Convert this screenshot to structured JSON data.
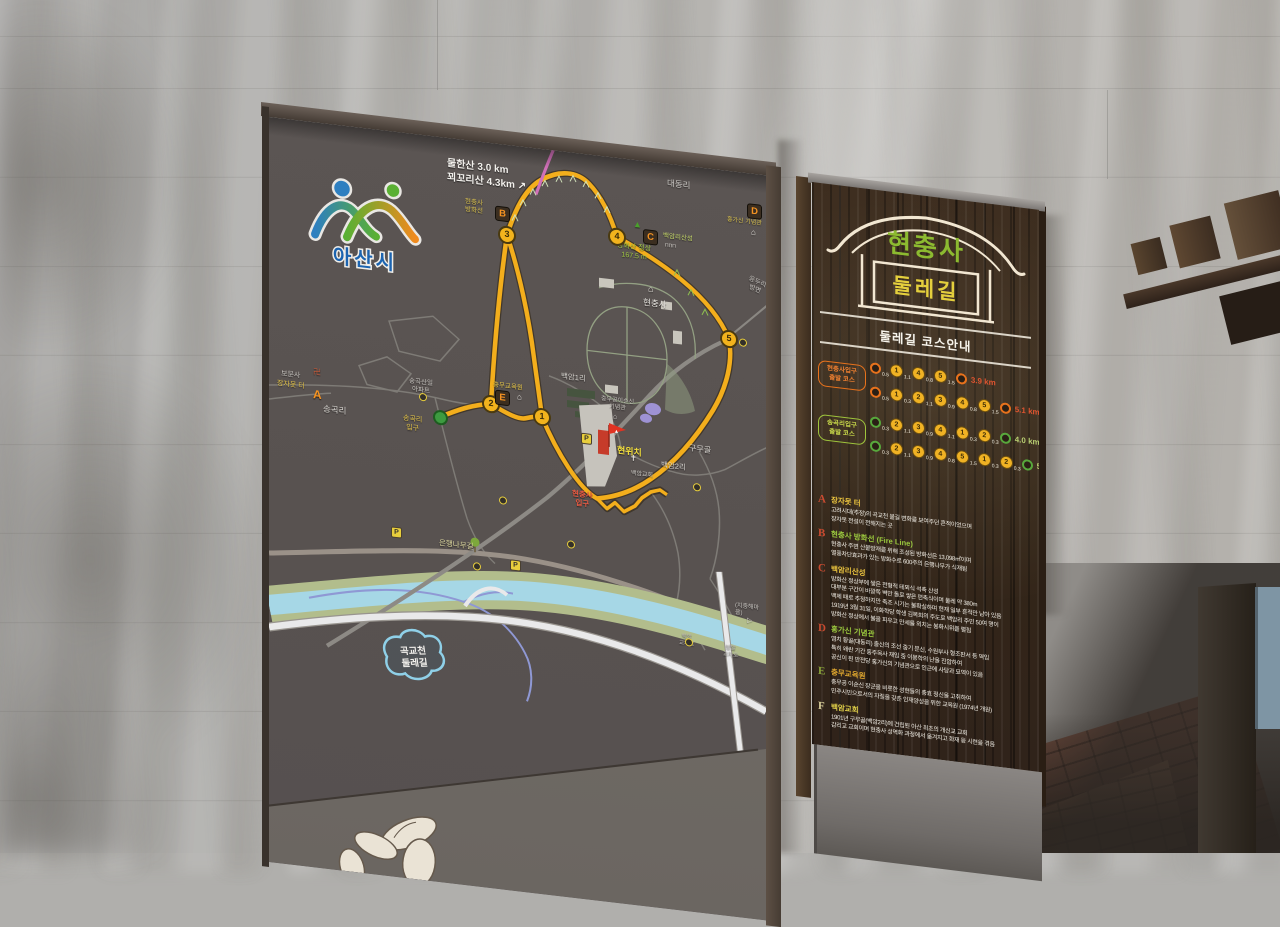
{
  "asan_city": {
    "name": "아산시"
  },
  "map": {
    "labels": [
      {
        "t": "물한산   3.0 km",
        "x": 178,
        "y": 20,
        "fs": 10,
        "c": "#f2f0ec",
        "w": 1
      },
      {
        "t": "꾀꼬리산  4.3km ↗",
        "x": 178,
        "y": 34,
        "fs": 10,
        "c": "#f2f0ec",
        "w": 1
      },
      {
        "t": "대동리",
        "x": 398,
        "y": 14,
        "fs": 8.5,
        "c": "#cfccc8"
      },
      {
        "t": "현충사\n방화선",
        "x": 196,
        "y": 58,
        "fs": 6.5,
        "c": "#d8c050",
        "ta": "center"
      },
      {
        "t": "백암리산성",
        "x": 394,
        "y": 69,
        "fs": 6.5,
        "c": "#c6d86a"
      },
      {
        "t": "방화산 정상\n167.5 m",
        "x": 348,
        "y": 84,
        "fs": 7,
        "c": "#a2c845",
        "ta": "center"
      },
      {
        "t": "홍가신 기념관",
        "x": 458,
        "y": 46,
        "fs": 6,
        "c": "#d8c050"
      },
      {
        "t": "응두리\n방면",
        "x": 478,
        "y": 104,
        "fs": 6.5,
        "c": "#c8c5c0",
        "r": 18,
        "ta": "center"
      },
      {
        "t": "현충사",
        "x": 374,
        "y": 136,
        "fs": 8.5,
        "c": "#e8e5e0"
      },
      {
        "t": "보문사",
        "x": 12,
        "y": 252,
        "fs": 7,
        "c": "#c8c5c0"
      },
      {
        "t": "卍",
        "x": 44,
        "y": 245,
        "fs": 8,
        "c": "#c05838"
      },
      {
        "t": "장자못 터",
        "x": 8,
        "y": 262,
        "fs": 7,
        "c": "#e4c44a"
      },
      {
        "t": "송곡리",
        "x": 54,
        "y": 280,
        "fs": 8.5,
        "c": "#d8d5d0"
      },
      {
        "t": "송곡산일\n아파트",
        "x": 140,
        "y": 244,
        "fs": 6.5,
        "c": "#c8c5c0",
        "ta": "center"
      },
      {
        "t": "송곡리\n입구",
        "x": 134,
        "y": 282,
        "fs": 7,
        "c": "#e4c44a",
        "ta": "center"
      },
      {
        "t": "충무교육원",
        "x": 224,
        "y": 238,
        "fs": 6.5,
        "c": "#e4c44a"
      },
      {
        "t": "백암1리",
        "x": 292,
        "y": 220,
        "fs": 7.5,
        "c": "#d8d5d0"
      },
      {
        "t": "충무공이순신\n기념관",
        "x": 332,
        "y": 240,
        "fs": 6,
        "c": "#c8c5c0",
        "ta": "center"
      },
      {
        "t": "현위치",
        "x": 348,
        "y": 287,
        "fs": 9,
        "c": "#f0dc3c",
        "w": 1
      },
      {
        "t": "현충사\n입구",
        "x": 303,
        "y": 336,
        "fs": 7.5,
        "c": "#e85a42",
        "w": 1,
        "ta": "center"
      },
      {
        "t": "백암교회",
        "x": 362,
        "y": 311,
        "fs": 6,
        "c": "#c8c5c0"
      },
      {
        "t": "백암2리",
        "x": 392,
        "y": 297,
        "fs": 7.5,
        "c": "#d8d5d0"
      },
      {
        "t": "구무골",
        "x": 420,
        "y": 277,
        "fs": 8,
        "c": "#d8d5d0"
      },
      {
        "t": "은행나무길",
        "x": 170,
        "y": 401,
        "fs": 7.5,
        "c": "#ded9a0"
      },
      {
        "t": "(지중해마을)",
        "x": 466,
        "y": 431,
        "fs": 6,
        "c": "#c8c5c0"
      },
      {
        "t": "백암\n교차로",
        "x": 410,
        "y": 468,
        "fs": 5.5,
        "c": "#b8b5b0",
        "ta": "center"
      },
      {
        "t": "방말\n교차로",
        "x": 454,
        "y": 474,
        "fs": 5.5,
        "c": "#b8b5b0",
        "ta": "center"
      }
    ],
    "trail_points": [
      {
        "n": "1",
        "x": 273,
        "y": 268
      },
      {
        "n": "2",
        "x": 222,
        "y": 261
      },
      {
        "n": "3",
        "x": 238,
        "y": 90
      },
      {
        "n": "4",
        "x": 348,
        "y": 79
      },
      {
        "n": "5",
        "x": 460,
        "y": 168
      }
    ],
    "letter_markers": [
      {
        "t": "A",
        "x": 44,
        "y": 266,
        "boxed": false
      },
      {
        "t": "B",
        "x": 226,
        "y": 62,
        "boxed": true
      },
      {
        "t": "C",
        "x": 374,
        "y": 68,
        "boxed": true
      },
      {
        "t": "D",
        "x": 478,
        "y": 30,
        "boxed": true
      },
      {
        "t": "E",
        "x": 226,
        "y": 246,
        "boxed": true
      }
    ],
    "parking_markers": [
      {
        "x": 312,
        "y": 279
      },
      {
        "x": 122,
        "y": 395
      },
      {
        "x": 241,
        "y": 414
      }
    ],
    "ring_markers": [
      {
        "x": 150,
        "y": 258
      },
      {
        "x": 230,
        "y": 352
      },
      {
        "x": 298,
        "y": 388
      },
      {
        "x": 424,
        "y": 316
      },
      {
        "x": 204,
        "y": 421
      },
      {
        "x": 416,
        "y": 472
      },
      {
        "x": 470,
        "y": 166
      }
    ],
    "start_marker": {
      "x": 171,
      "y": 280
    },
    "icons": [
      {
        "g": "⌂",
        "x": 379,
        "y": 123,
        "c": "#e8e5e0",
        "fs": 9,
        "n": "hyeonchungsa-house-icon"
      },
      {
        "g": "⌂",
        "x": 482,
        "y": 55,
        "c": "#e8e5e0",
        "fs": 8,
        "n": "memorial-house-icon"
      },
      {
        "g": "⌂",
        "x": 248,
        "y": 247,
        "c": "#e8e5e0",
        "fs": 8,
        "n": "education-house-icon"
      },
      {
        "g": "⌂",
        "x": 344,
        "y": 256,
        "c": "#d8d5d0",
        "fs": 7,
        "n": "museum-house-icon"
      },
      {
        "g": "▲",
        "x": 364,
        "y": 60,
        "c": "#4aa02c",
        "fs": 9,
        "n": "peak-icon"
      },
      {
        "g": "✝",
        "x": 361,
        "y": 295,
        "c": "#e8e5e0",
        "fs": 8,
        "n": "church-cross-icon"
      },
      {
        "g": "▷",
        "x": 478,
        "y": 444,
        "c": "#d8d5d0",
        "fs": 7,
        "n": "boat-icon"
      },
      {
        "g": "ΠΠΠ",
        "x": 396,
        "y": 80,
        "c": "#d8d5d0",
        "fs": 5,
        "n": "fortress-wall-icon"
      }
    ],
    "bubble": {
      "line1": "곡교천",
      "line2": "둘레길"
    }
  },
  "info_sign": {
    "emblem": {
      "top": "현충사",
      "bottom": "둘레길"
    },
    "course_title": "둘레길 코스안내",
    "groups": [
      {
        "label": "현충사입구\n출발 코스",
        "theme": "orange",
        "courses": [
          {
            "legs": [
              [
                "0.5",
                "1"
              ],
              [
                "1.1",
                "4"
              ],
              [
                "0.8",
                "5"
              ]
            ],
            "tail": "1.5",
            "total": "3.9 km"
          },
          {
            "legs": [
              [
                "0.5",
                "1"
              ],
              [
                "0.3",
                "2"
              ],
              [
                "1.1",
                "3"
              ],
              [
                "0.9",
                "4"
              ],
              [
                "0.8",
                "5"
              ]
            ],
            "tail": "1.5",
            "total": "5.1 km"
          }
        ]
      },
      {
        "label": "송곡리입구\n출발 코스",
        "theme": "green",
        "courses": [
          {
            "legs": [
              [
                "0.3",
                "2"
              ],
              [
                "1.1",
                "3"
              ],
              [
                "0.9",
                "4"
              ],
              [
                "1.1",
                "1"
              ],
              [
                "0.3",
                "2"
              ]
            ],
            "tail": "0.3",
            "total": "4.0 km"
          },
          {
            "legs": [
              [
                "0.3",
                "2"
              ],
              [
                "1.1",
                "3"
              ],
              [
                "0.9",
                "4"
              ],
              [
                "0.8",
                "5"
              ],
              [
                "1.5",
                "1"
              ],
              [
                "0.3",
                "2"
              ]
            ],
            "tail": "0.3",
            "total": "5.2 km"
          }
        ]
      }
    ],
    "legend": [
      {
        "letter": "A",
        "letter_color": "#c94b30",
        "title": "장자못 터",
        "title_color": "#e8c23e",
        "lines": [
          "고려시대(추정)의 곡교천 물길 변화를 보여주던 흔적이었으며",
          "장자못 전설이 전해지는 곳"
        ]
      },
      {
        "letter": "B",
        "letter_color": "#c94b30",
        "title": "현충사 방화선 (Fire Line)",
        "title_color": "#9bc93e",
        "lines": [
          "현충사 주변 산불방재를 위해 조성된 방화선은 13,098㎡이며",
          "열풍차단효과가 있는 방화수로 600주의 은행나무가 식재됨"
        ]
      },
      {
        "letter": "C",
        "letter_color": "#c94b30",
        "title": "백암리산성",
        "title_color": "#e8c23e",
        "lines": [
          "방화산 정상부에 쌓은 전형적 테뫼식 석축 산성",
          "대부분 구간이 바깥쪽 벽만 돌로 쌓은 편축식이며 둘레 약 380m",
          "백제 때로 추정하지만 축조 시기는 불확실하며 현재 일부 흔적만 남아 있음",
          "1919년 3월 31일, 이화학당 학생 김복희의 주도로 백암리 주민 50여 명이",
          "방화산 정상에서 불을 피우고 만세를 외치는 봉화시위를 펼침"
        ]
      },
      {
        "letter": "D",
        "letter_color": "#c94b30",
        "title": "홍가신 기념관",
        "title_color": "#9bc93e",
        "lines": [
          "염치 황골(대동리) 출신의 조선 중기 문신, 수원부사 형조판서 등 역임",
          "특히 왜란 기간 홍주목사 재임 중 이몽학의 난을 진압하여",
          "공신이 된 만전당 홍가신의 기념관으로 인근에 사당과 묘역이 있음"
        ]
      },
      {
        "letter": "E",
        "letter_color": "#8aa43a",
        "title": "충무교육원",
        "title_color": "#dca52e",
        "lines": [
          "충무공 이순신 장군을 비롯한 성현들의 충효 정신을 고취하여",
          "민주시민으로서의 자질을 갖춘 인재양성을 위한 교육원 (1974년 개원)"
        ]
      },
      {
        "letter": "F",
        "letter_color": "#d8cf9a",
        "title": "백암교회",
        "title_color": "#e0d049",
        "lines": [
          "1901년 구무골(백암2리)에 건립된 아산 최초의 개신교 교회",
          "감리교 교회이며 현충사 성역화 과정에서 옮겨지고 화재 등 시련을 겪음"
        ]
      }
    ]
  }
}
